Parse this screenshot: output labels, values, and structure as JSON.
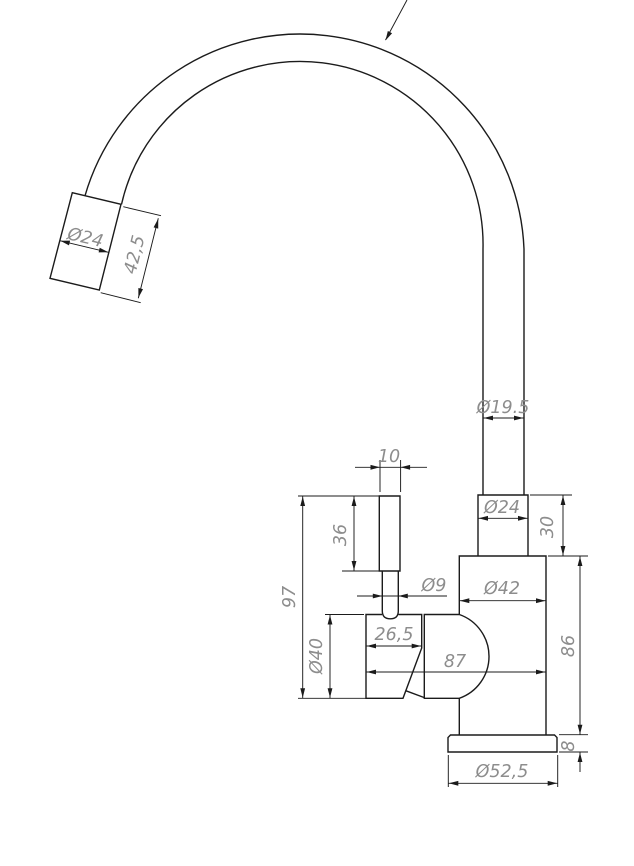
{
  "drawing": {
    "title": "Kitchen faucet technical drawing, side view",
    "units": "mm",
    "colors": {
      "outline": "#1b1b1b",
      "dimension_text": "#8d8d8d",
      "background": "#ffffff"
    },
    "dimensions": {
      "spout_tip_diameter": "Ø24",
      "spout_tip_length": "42,5",
      "spout_tube_diameter": "Ø19.5",
      "riser_collar_diameter": "Ø24",
      "riser_collar_height": "30",
      "body_diameter": "Ø42",
      "body_height": "86",
      "base_flange_height": "8",
      "base_flange_diameter": "Ø52,5",
      "overall_depth": "87",
      "handle_housing_width": "26,5",
      "handle_pin_diameter": "Ø9",
      "lever_width": "10",
      "lever_length": "36",
      "handle_total_height": "97",
      "handle_housing_diameter": "Ø40"
    }
  }
}
